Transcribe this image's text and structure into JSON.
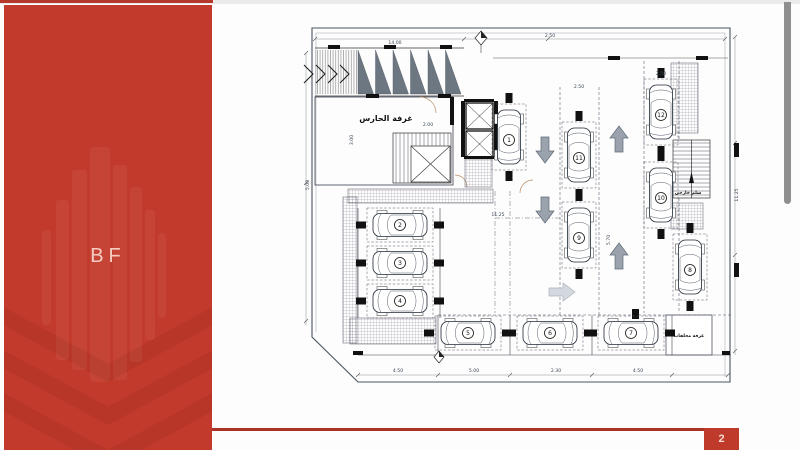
{
  "slide": {
    "logo_text": "BF",
    "page_number": "2"
  },
  "colors": {
    "accent": "#c23a2b",
    "footer_line": "#a93326",
    "badge": "#bf3a2b",
    "scrollbar": "#8f8f8f",
    "arrow_gray": "#9aa3ad"
  },
  "plan": {
    "labels": [
      {
        "t": "غرفة الحارس",
        "x": 88,
        "y": 96,
        "s": 8
      },
      {
        "t": "سلم خارجي",
        "x": 390,
        "y": 169,
        "s": 4.5
      },
      {
        "t": "غرفة مخلفات",
        "x": 391,
        "y": 312,
        "s": 4.5
      }
    ],
    "cars": [
      {
        "n": "1",
        "x": 211,
        "y": 112,
        "o": "v"
      },
      {
        "n": "2",
        "x": 102,
        "y": 200,
        "o": "h"
      },
      {
        "n": "3",
        "x": 102,
        "y": 238,
        "o": "h"
      },
      {
        "n": "4",
        "x": 102,
        "y": 276,
        "o": "h"
      },
      {
        "n": "5",
        "x": 170,
        "y": 308,
        "o": "h"
      },
      {
        "n": "6",
        "x": 252,
        "y": 308,
        "o": "h"
      },
      {
        "n": "7",
        "x": 333,
        "y": 308,
        "o": "h"
      },
      {
        "n": "8",
        "x": 392,
        "y": 242,
        "o": "v"
      },
      {
        "n": "9",
        "x": 281,
        "y": 210,
        "o": "v"
      },
      {
        "n": "10",
        "x": 363,
        "y": 170,
        "o": "v"
      },
      {
        "n": "11",
        "x": 281,
        "y": 130,
        "o": "v"
      },
      {
        "n": "12",
        "x": 363,
        "y": 87,
        "o": "v"
      }
    ],
    "arrows": [
      {
        "x": 247,
        "y": 125,
        "dir": "down"
      },
      {
        "x": 247,
        "y": 185,
        "dir": "down"
      },
      {
        "x": 321,
        "y": 114,
        "dir": "up"
      },
      {
        "x": 321,
        "y": 231,
        "dir": "up"
      },
      {
        "x": 264,
        "y": 267,
        "dir": "right",
        "light": true
      }
    ],
    "dims": [
      {
        "x": 97,
        "y": 19,
        "t": "14.00",
        "r": 0
      },
      {
        "x": 252,
        "y": 12,
        "t": "2.50",
        "r": 0
      },
      {
        "x": 363,
        "y": 50,
        "t": "2.50",
        "r": 0
      },
      {
        "x": 281,
        "y": 63,
        "t": "2.50",
        "r": 0
      },
      {
        "x": 200,
        "y": 191,
        "t": "11.25",
        "r": 0
      },
      {
        "x": 312,
        "y": 215,
        "t": "5.70",
        "r": -90
      },
      {
        "x": 440,
        "y": 170,
        "t": "11.25",
        "r": -90
      },
      {
        "x": 100,
        "y": 347,
        "t": "4.50",
        "r": 0
      },
      {
        "x": 176,
        "y": 347,
        "t": "5.00",
        "r": 0
      },
      {
        "x": 258,
        "y": 347,
        "t": "2.30",
        "r": 0
      },
      {
        "x": 340,
        "y": 347,
        "t": "4.50",
        "r": 0
      },
      {
        "x": 11,
        "y": 160,
        "t": "5.00",
        "r": -90
      },
      {
        "x": 55,
        "y": 115,
        "t": "3.00",
        "r": -90
      },
      {
        "x": 130,
        "y": 101,
        "t": "2.00",
        "r": 0
      }
    ],
    "walls": [
      [
        30,
        20,
        12,
        4
      ],
      [
        86,
        20,
        12,
        4
      ],
      [
        142,
        20,
        12,
        4
      ],
      [
        68,
        69,
        13,
        4
      ],
      [
        140,
        69,
        13,
        4
      ],
      [
        310,
        31,
        12,
        4
      ],
      [
        398,
        31,
        12,
        4
      ],
      [
        163,
        76,
        4,
        56
      ],
      [
        196,
        76,
        4,
        56
      ],
      [
        166,
        74,
        30,
        3
      ],
      [
        166,
        131,
        30,
        3
      ],
      [
        436,
        118,
        5,
        14
      ],
      [
        436,
        238,
        5,
        14
      ],
      [
        152,
        72,
        4,
        28
      ],
      [
        334,
        284,
        7,
        10
      ],
      [
        55,
        326,
        10,
        4
      ],
      [
        424,
        326,
        8,
        4
      ]
    ],
    "hatches": [
      [
        373,
        38,
        27,
        70
      ],
      [
        373,
        178,
        32,
        26
      ],
      [
        45,
        172,
        14,
        146
      ],
      [
        52,
        293,
        86,
        26
      ],
      [
        50,
        164,
        145,
        14
      ],
      [
        167,
        134,
        27,
        28
      ]
    ]
  }
}
